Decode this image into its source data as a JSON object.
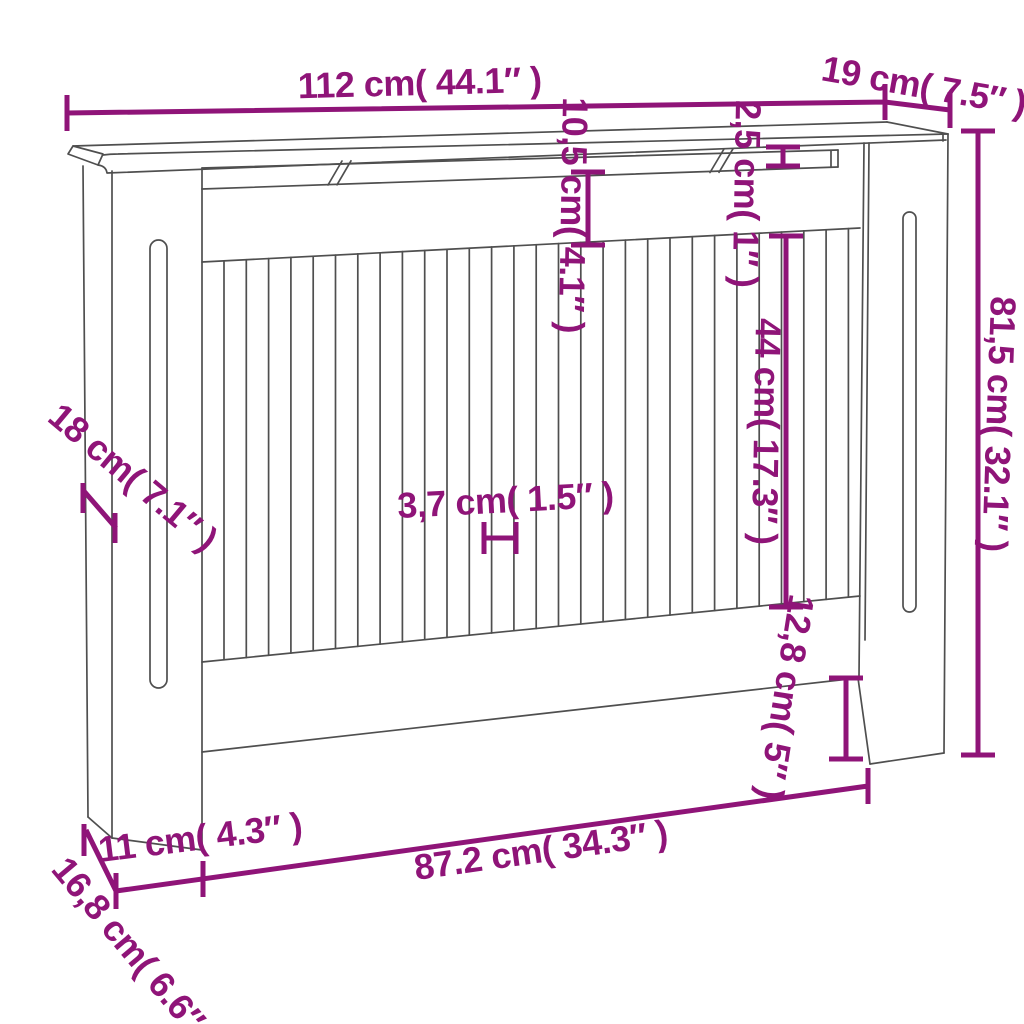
{
  "diagram": {
    "accent_color": "#8F1478",
    "drawing_line_color": "#4f4f4f",
    "dimensions": {
      "top_width": {
        "cm": "112",
        "inch": "44.1",
        "label": "112 cm( 44.1″ )"
      },
      "top_depth": {
        "cm": "19",
        "inch": "7.5",
        "label": "19 cm( 7.5″ )"
      },
      "top_rail_height": {
        "cm": "10,5",
        "inch": "4.1",
        "label": "10,5 cm( 4.1″ )"
      },
      "top_board_thickness": {
        "cm": "2,5",
        "inch": "1",
        "label": "2,5 cm( 1″ )"
      },
      "slat_height": {
        "cm": "44",
        "inch": "17.3",
        "label": "44 cm( 17.3″ )"
      },
      "side_height": {
        "cm": "81,5",
        "inch": "32.1",
        "label": "81,5 cm( 32.1″ )"
      },
      "side_depth": {
        "cm": "18",
        "inch": "7.1",
        "label": "18 cm( 7.1″ )"
      },
      "slat_width": {
        "cm": "3,7",
        "inch": "1.5",
        "label": "3,7 cm( 1.5″ )"
      },
      "leg_height": {
        "cm": "12,8",
        "inch": "5",
        "label": "12,8 cm( 5″ )"
      },
      "bottom_side_depth": {
        "cm": "16,8",
        "inch": "6.6",
        "label": "16,8 cm( 6.6″ )"
      },
      "leg_width": {
        "cm": "11",
        "inch": "4.3",
        "label": "11 cm( 4.3″ )"
      },
      "opening_width": {
        "cm": "87.2",
        "inch": "34.3",
        "label": "87.2 cm( 34.3″ )"
      }
    }
  }
}
